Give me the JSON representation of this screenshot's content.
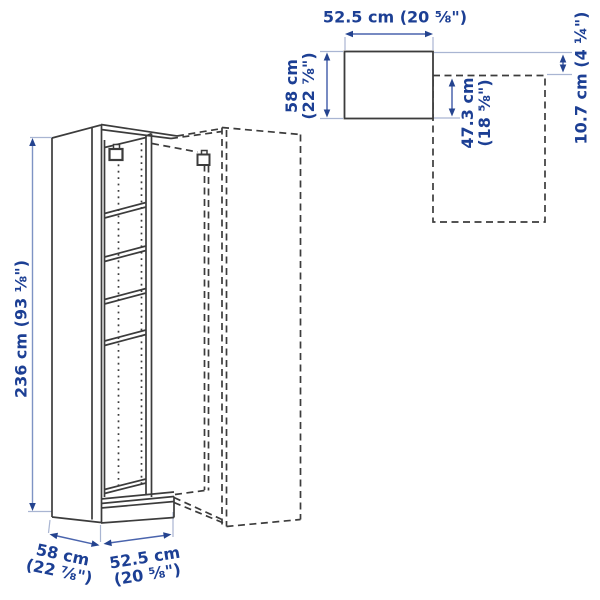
{
  "figure": {
    "type": "product-dimension-diagram",
    "colors": {
      "label_text": "#1c3f94",
      "dimension_arrow": "#4a64ad",
      "arrowhead": "#24438f",
      "extension_line": "#a9b5d2",
      "artwork_line": "#3c3c3c",
      "background": "#ffffff"
    },
    "labels": {
      "height": "236 cm (93 ⅛\")",
      "top_view_width": "52.5 cm (20 ⅝\")",
      "top_view_depth_l1": "58 cm",
      "top_view_depth_l2": "(22 ⅞\")",
      "corner_inner_depth_l1": "47.3 cm",
      "corner_inner_depth_l2": "(18 ⅝\")",
      "corner_offset": "10.7 cm (4 ¼\")",
      "base_depth_l1": "58 cm",
      "base_depth_l2": "(22 ⅞\")",
      "base_width_l1": "52.5 cm",
      "base_width_l2": "(20 ⅝\")"
    }
  }
}
